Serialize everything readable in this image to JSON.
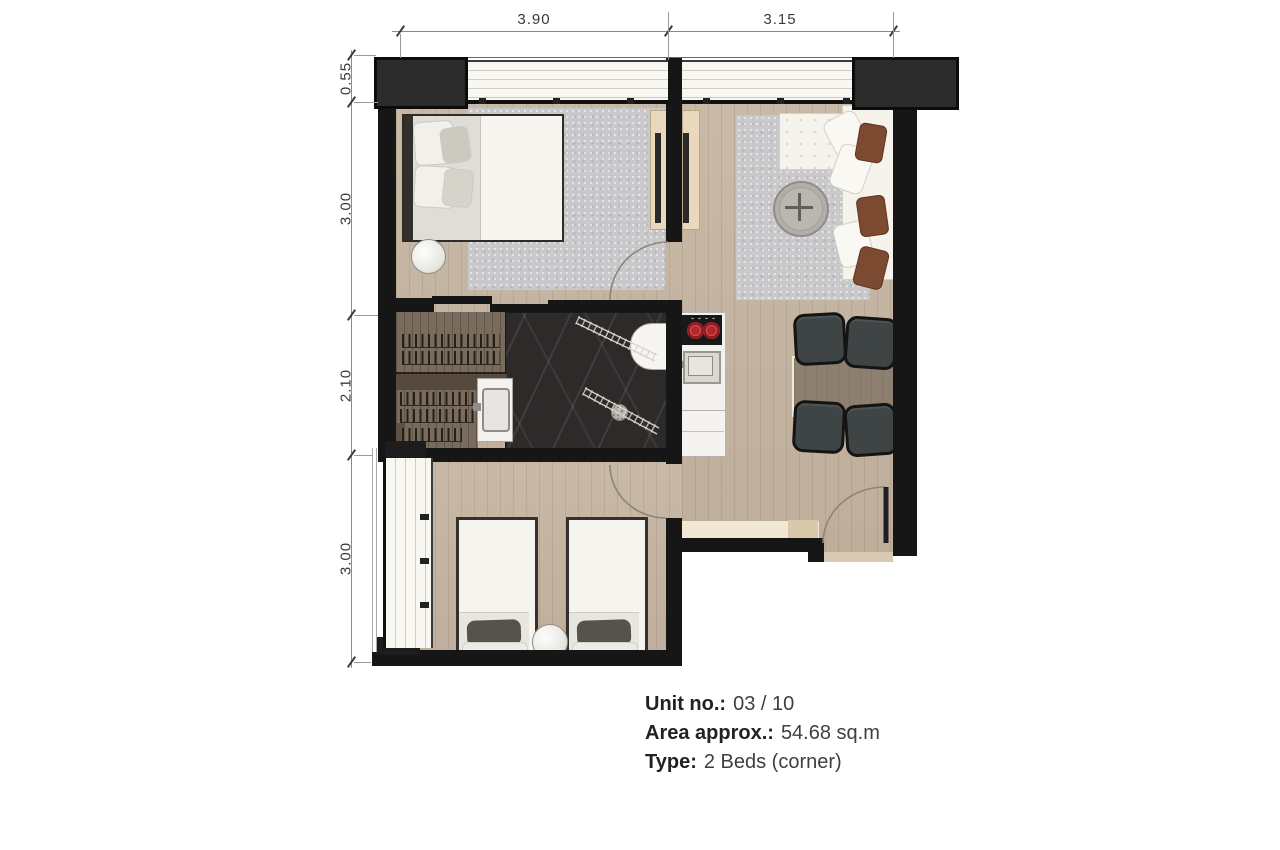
{
  "dimensions": {
    "top": [
      {
        "label": "3.90"
      },
      {
        "label": "3.15"
      }
    ],
    "left": [
      {
        "label": "0.55"
      },
      {
        "label": "3.00"
      },
      {
        "label": "2.10"
      },
      {
        "label": "3.00"
      }
    ]
  },
  "unit_info": {
    "lines": [
      {
        "label": "Unit no.:",
        "value": "03 / 10"
      },
      {
        "label": "Area approx.:",
        "value": "54.68 sq.m"
      },
      {
        "label": "Type:",
        "value": "2 Beds (corner)"
      }
    ]
  },
  "colors": {
    "wall": "#161616",
    "floor_wood": "#c6b5a2",
    "closet_wood": "#7a6c5c",
    "bathroom_marble": "#2d2b2a",
    "rug": "#c9c9cc",
    "window": "#f8f7f2",
    "cooktop_red": "#b3272c",
    "sofa_cushion_brown": "#7c4a31",
    "console_beige": "#e9d8bc",
    "dining_table": "#8e8070",
    "text": "#3a3a3a"
  }
}
